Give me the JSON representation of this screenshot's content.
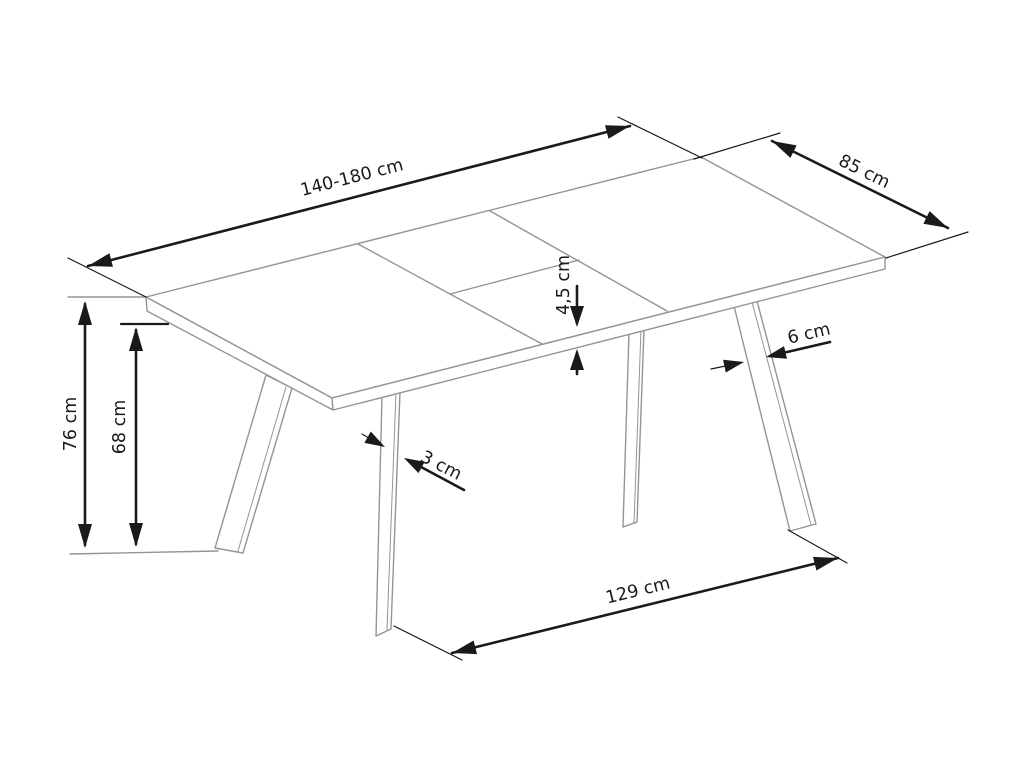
{
  "labels": {
    "length": "140-180 cm",
    "width": "85 cm",
    "top_thickness": "4,5 cm",
    "leg_width": "6 cm",
    "leg_thickness": "3 cm",
    "height": "76 cm",
    "clearance_height": "68 cm",
    "leg_span": "129 cm"
  },
  "colors": {
    "background": "#ffffff",
    "outline": "#949494",
    "dimension": "#1a1a1a"
  }
}
